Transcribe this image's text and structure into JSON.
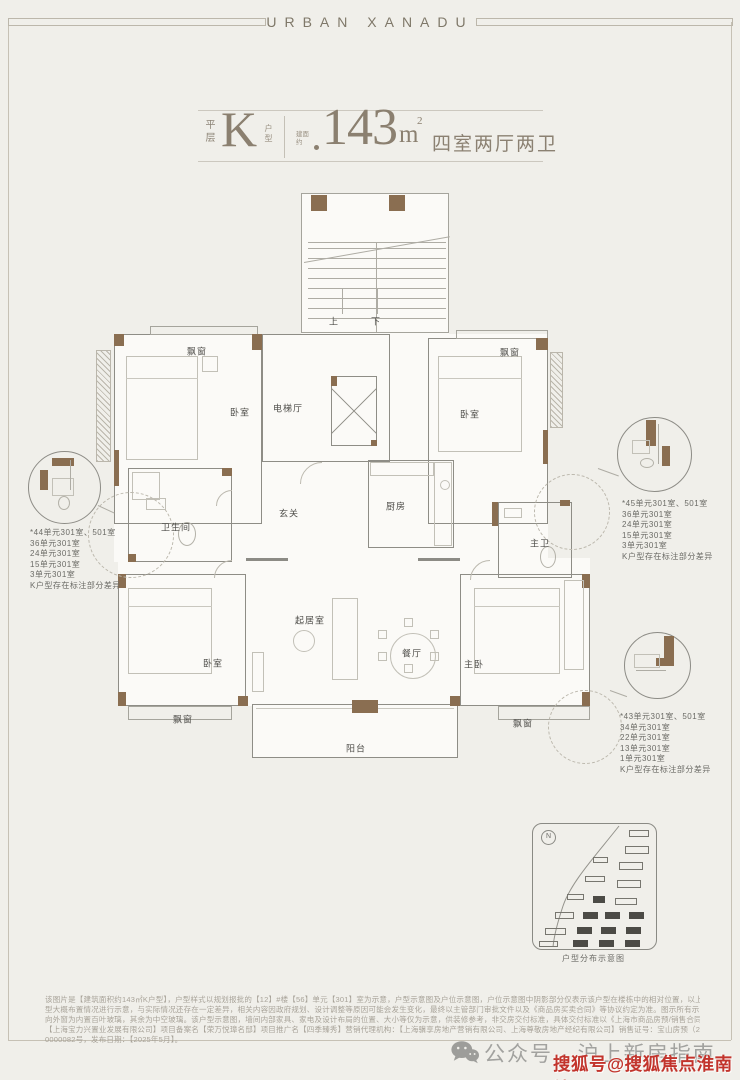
{
  "brand": "URBAN XANADU",
  "title": {
    "layout_top": "平层",
    "type_letter": "K",
    "layout_bottom": "户型",
    "area_prefix": "建面约",
    "area_value": "143",
    "area_unit_base": "m",
    "area_unit_sup": "2",
    "rooms_text": "四室两厅两卫"
  },
  "floorplan": {
    "labels": [
      [
        197,
        351,
        "飘窗"
      ],
      [
        240,
        412,
        "卧室"
      ],
      [
        288,
        408,
        "电梯厅"
      ],
      [
        510,
        352,
        "飘窗"
      ],
      [
        470,
        414,
        "卧室"
      ],
      [
        289,
        513,
        "玄关"
      ],
      [
        396,
        506,
        "厨房"
      ],
      [
        176,
        527,
        "卫生间"
      ],
      [
        540,
        543,
        "主卫"
      ],
      [
        310,
        620,
        "起居室"
      ],
      [
        412,
        653,
        "餐厅"
      ],
      [
        213,
        663,
        "卧室"
      ],
      [
        474,
        664,
        "主卧"
      ],
      [
        183,
        719,
        "飘窗"
      ],
      [
        523,
        723,
        "飘窗"
      ],
      [
        356,
        748,
        "阳台"
      ],
      [
        334,
        321,
        "上"
      ],
      [
        376,
        321,
        "下"
      ]
    ],
    "shapes": [
      [
        114,
        334,
        434,
        228,
        "bgw"
      ],
      [
        118,
        558,
        472,
        148,
        "bgw"
      ],
      [
        301,
        193,
        148,
        141,
        "bgw"
      ],
      [
        252,
        704,
        206,
        54,
        "bgw"
      ],
      [
        96,
        350,
        15,
        112,
        "hat"
      ],
      [
        550,
        352,
        13,
        76,
        "hat"
      ],
      [
        301,
        193,
        148,
        140,
        "rooml"
      ],
      [
        308,
        242,
        138,
        1,
        "ln"
      ],
      [
        308,
        248,
        138,
        1,
        "ln"
      ],
      [
        308,
        258,
        138,
        1,
        "ln"
      ],
      [
        308,
        268,
        138,
        1,
        "ln"
      ],
      [
        308,
        278,
        138,
        1,
        "ln"
      ],
      [
        308,
        288,
        138,
        1,
        "ln"
      ],
      [
        308,
        298,
        138,
        1,
        "ln"
      ],
      [
        308,
        308,
        138,
        1,
        "ln"
      ],
      [
        308,
        318,
        138,
        1,
        "ln"
      ],
      [
        376,
        242,
        1,
        90,
        "ln"
      ],
      [
        304,
        262,
        148,
        1,
        "ln",
        -10
      ],
      [
        342,
        288,
        1,
        26,
        "ln"
      ],
      [
        377,
        288,
        1,
        26,
        "ln"
      ],
      [
        311,
        195,
        16,
        16,
        "wb"
      ],
      [
        389,
        195,
        16,
        16,
        "wb"
      ],
      [
        114,
        334,
        148,
        190,
        "room"
      ],
      [
        262,
        334,
        128,
        128,
        "room"
      ],
      [
        428,
        338,
        120,
        186,
        "room"
      ],
      [
        368,
        460,
        86,
        88,
        "room"
      ],
      [
        128,
        468,
        104,
        94,
        "room"
      ],
      [
        498,
        502,
        74,
        76,
        "room"
      ],
      [
        118,
        574,
        128,
        132,
        "room"
      ],
      [
        460,
        574,
        130,
        132,
        "room"
      ],
      [
        252,
        704,
        206,
        54,
        "room"
      ],
      [
        256,
        708,
        198,
        1,
        "lnl"
      ],
      [
        150,
        326,
        108,
        9,
        "rooml"
      ],
      [
        456,
        330,
        92,
        9,
        "rooml"
      ],
      [
        128,
        706,
        104,
        14,
        "rooml"
      ],
      [
        498,
        706,
        92,
        14,
        "rooml"
      ],
      [
        331,
        376,
        46,
        70,
        "x"
      ],
      [
        246,
        558,
        42,
        3,
        "wg"
      ],
      [
        418,
        558,
        42,
        3,
        "wg"
      ],
      [
        114,
        334,
        10,
        12,
        "wb"
      ],
      [
        252,
        334,
        10,
        16,
        "wb"
      ],
      [
        536,
        338,
        12,
        12,
        "wb"
      ],
      [
        543,
        430,
        5,
        34,
        "wb"
      ],
      [
        114,
        450,
        5,
        36,
        "wb"
      ],
      [
        222,
        468,
        10,
        8,
        "wb"
      ],
      [
        128,
        554,
        8,
        8,
        "wb"
      ],
      [
        118,
        574,
        8,
        14,
        "wb"
      ],
      [
        118,
        692,
        8,
        14,
        "wb"
      ],
      [
        238,
        696,
        10,
        10,
        "wb"
      ],
      [
        450,
        696,
        10,
        10,
        "wb"
      ],
      [
        582,
        574,
        8,
        14,
        "wb"
      ],
      [
        582,
        692,
        8,
        14,
        "wb"
      ],
      [
        331,
        376,
        6,
        10,
        "wb"
      ],
      [
        371,
        440,
        6,
        6,
        "wb"
      ],
      [
        492,
        502,
        6,
        24,
        "wb"
      ],
      [
        560,
        500,
        10,
        6,
        "wb"
      ],
      [
        352,
        700,
        26,
        13,
        "wb"
      ],
      [
        126,
        356,
        72,
        104,
        "fur"
      ],
      [
        126,
        378,
        72,
        1,
        "lnl"
      ],
      [
        202,
        356,
        16,
        16,
        "fur"
      ],
      [
        438,
        356,
        84,
        96,
        "fur"
      ],
      [
        438,
        378,
        84,
        1,
        "lnl"
      ],
      [
        128,
        588,
        84,
        86,
        "fur"
      ],
      [
        128,
        606,
        84,
        1,
        "lnl"
      ],
      [
        474,
        588,
        86,
        86,
        "fur"
      ],
      [
        474,
        606,
        86,
        1,
        "lnl"
      ],
      [
        564,
        580,
        20,
        90,
        "fur"
      ],
      [
        332,
        598,
        26,
        82,
        "fur"
      ],
      [
        293,
        630,
        22,
        22,
        "circf"
      ],
      [
        252,
        652,
        12,
        40,
        "fur"
      ],
      [
        390,
        633,
        46,
        46,
        "circf"
      ],
      [
        404,
        618,
        9,
        9,
        "fur"
      ],
      [
        430,
        630,
        9,
        9,
        "fur"
      ],
      [
        430,
        652,
        9,
        9,
        "fur"
      ],
      [
        404,
        664,
        9,
        9,
        "fur"
      ],
      [
        378,
        652,
        9,
        9,
        "fur"
      ],
      [
        378,
        630,
        9,
        9,
        "fur"
      ],
      [
        434,
        462,
        18,
        84,
        "fur"
      ],
      [
        370,
        462,
        64,
        14,
        "fur"
      ],
      [
        440,
        480,
        10,
        10,
        "circf"
      ],
      [
        178,
        522,
        18,
        24,
        "ell"
      ],
      [
        146,
        498,
        20,
        12,
        "fur"
      ],
      [
        132,
        472,
        28,
        28,
        "fur"
      ],
      [
        540,
        546,
        16,
        22,
        "ell"
      ],
      [
        504,
        508,
        18,
        10,
        "fur"
      ],
      [
        300,
        462,
        44,
        44,
        "arc"
      ],
      [
        216,
        490,
        32,
        32,
        "arc"
      ],
      [
        214,
        560,
        36,
        36,
        "arc"
      ],
      [
        470,
        560,
        40,
        40,
        "arc"
      ],
      [
        88,
        492,
        86,
        86,
        "cird"
      ],
      [
        534,
        474,
        76,
        76,
        "cird"
      ],
      [
        548,
        690,
        74,
        74,
        "cird"
      ],
      [
        98,
        505,
        18,
        1,
        "ln",
        25
      ],
      [
        598,
        468,
        22,
        1,
        "ln",
        20
      ],
      [
        610,
        690,
        18,
        1,
        "ln",
        20
      ],
      [
        28,
        451,
        73,
        73,
        "circs"
      ],
      [
        617,
        417,
        75,
        75,
        "circs"
      ],
      [
        624,
        632,
        67,
        67,
        "circs"
      ],
      [
        52,
        458,
        22,
        8,
        "wb"
      ],
      [
        40,
        470,
        8,
        20,
        "wb"
      ],
      [
        52,
        478,
        22,
        18,
        "fur"
      ],
      [
        58,
        496,
        12,
        14,
        "ell"
      ],
      [
        70,
        460,
        1,
        30,
        "ln"
      ],
      [
        646,
        420,
        10,
        26,
        "wb"
      ],
      [
        662,
        446,
        8,
        20,
        "wb"
      ],
      [
        632,
        440,
        18,
        14,
        "fur"
      ],
      [
        640,
        458,
        14,
        10,
        "ell"
      ],
      [
        658,
        424,
        1,
        40,
        "ln"
      ],
      [
        664,
        636,
        10,
        24,
        "wb"
      ],
      [
        656,
        658,
        18,
        8,
        "wb"
      ],
      [
        634,
        654,
        26,
        14,
        "fur"
      ],
      [
        636,
        670,
        30,
        1,
        "ln"
      ]
    ]
  },
  "annotations": [
    {
      "lines": [
        "*44单元301室、501室",
        "36单元301室",
        "24单元301室",
        "15单元301室",
        "3单元301室",
        "K户型存在标注部分差异"
      ]
    },
    {
      "lines": [
        "*45单元301室、501室",
        "36单元301室",
        "24单元301室",
        "15单元301室",
        "3单元301室",
        "K户型存在标注部分差异"
      ]
    },
    {
      "lines": [
        "*43单元301室、501室",
        "34单元301室",
        "22单元301室",
        "13单元301室",
        "1单元301室",
        "K户型存在标注部分差异"
      ]
    }
  ],
  "inset": {
    "caption": "户型分布示意图",
    "compass": "N",
    "buildings": [
      [
        96,
        6,
        20,
        7,
        0
      ],
      [
        92,
        22,
        24,
        8,
        0
      ],
      [
        60,
        33,
        15,
        6,
        0
      ],
      [
        86,
        38,
        24,
        8,
        0
      ],
      [
        52,
        52,
        20,
        6,
        0
      ],
      [
        84,
        56,
        24,
        8,
        0
      ],
      [
        34,
        70,
        17,
        6,
        0
      ],
      [
        60,
        72,
        12,
        7,
        1
      ],
      [
        82,
        74,
        22,
        7,
        0
      ],
      [
        22,
        88,
        19,
        7,
        0
      ],
      [
        50,
        88,
        15,
        7,
        1
      ],
      [
        72,
        88,
        15,
        7,
        1
      ],
      [
        96,
        88,
        15,
        7,
        1
      ],
      [
        12,
        104,
        21,
        7,
        0
      ],
      [
        44,
        103,
        15,
        7,
        1
      ],
      [
        68,
        103,
        15,
        7,
        1
      ],
      [
        93,
        103,
        15,
        7,
        1
      ],
      [
        6,
        117,
        19,
        6,
        0
      ],
      [
        40,
        116,
        15,
        7,
        1
      ],
      [
        66,
        116,
        15,
        7,
        1
      ],
      [
        92,
        116,
        15,
        7,
        1
      ]
    ]
  },
  "disclaimer": {
    "lines": [
      "该图片是【建筑面积约143㎡K户型】，户型样式以规划报批的【12】#楼【56】单元【301】室为示意，户型示意图及户位示意图，户位示意图中阴影部分仅表示该户型在楼栋中的相对位置，以上图片旨在对项目户",
      "型大概布置情况进行示意，与实际情况还存在一定差异，相关内容因政府规划、设计调整等原因可能会发生变化，最终以主管部门审批文件以及《商品房买卖合同》等协议约定为准。图示所有示意房屋朝向、东西",
      "向外窗为内置百叶玻璃，其余为中空玻璃。该户型示意图，墙间内部家具、家电及设计布局的位置、大小等仅为示意，供装修参考，非交房交付标准，具体交付标准以《上海市商品房预/销售合同》为准。开发商：",
      "【上海宝力兴置业发展有限公司】项目备案名【荣万悦璋名邸】项目推广名【四季臻秀】营销代理机构：【上海骥享房地产营销有限公司、上海尊敬房地产经纪有限公司】销售证号：宝山房预（2025）预字",
      "0000082号，发布日期：【2025年5月】。"
    ]
  },
  "footer": {
    "wechat_label": "公众号 · 沪上新房指南",
    "watermark": "搜狐号@搜狐焦点淮南站"
  }
}
